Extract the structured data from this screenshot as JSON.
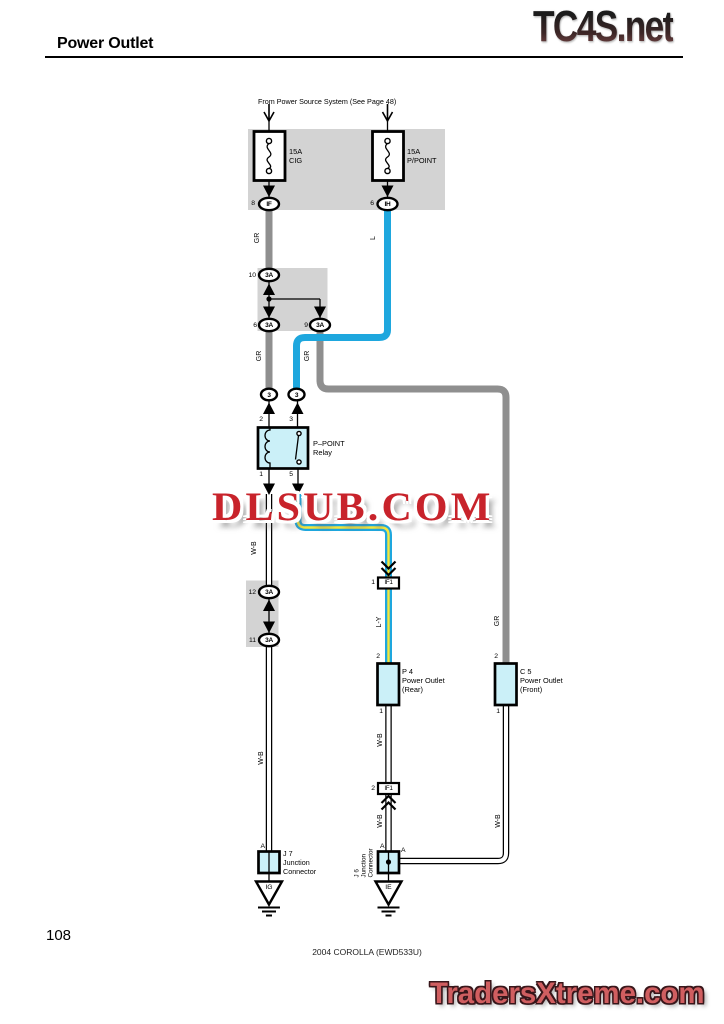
{
  "page": {
    "title": "Power Outlet",
    "page_number": "108",
    "footer_note": "2004 COROLLA (EWD533U)"
  },
  "watermarks": {
    "top_right": "TC4S.net",
    "center": "DLSUB.COM",
    "bottom_right": "TradersXtreme.com"
  },
  "colors": {
    "wire_blue": "#1ea7de",
    "wire_yellow": "#f5e73b",
    "wire_gray": "#8f8f8f",
    "box_gray": "#d3d3d3",
    "component_fill": "#cbf0f8",
    "watermark_red": "#c8232b"
  },
  "diagram": {
    "source_note": "From Power Source System (See Page 48)",
    "fuse_cig": {
      "amp": "15A",
      "name": "CIG",
      "pin": "8",
      "connector": "IF"
    },
    "fuse_ppoint": {
      "amp": "15A",
      "name": "P/POINT",
      "pin": "6",
      "connector": "IH"
    },
    "junction_a": {
      "top_pin": "10",
      "top": "3A",
      "left_pin": "6",
      "left": "3A",
      "right_pin": "9",
      "right": "3A"
    },
    "connector_left": "3",
    "connector_right": "3",
    "relay": {
      "pin_2": "2",
      "pin_3": "3",
      "pin_1": "1",
      "pin_5": "5",
      "name": "P–POINT",
      "type": "Relay"
    },
    "junction_b": {
      "top_pin": "12",
      "top": "3A",
      "bottom_pin": "11",
      "bottom": "3A"
    },
    "if1_upper": {
      "pin": "1",
      "name": "IF1"
    },
    "if1_lower": {
      "pin": "2",
      "name": "IF1"
    },
    "outlet_rear": {
      "pin_top": "2",
      "pin_bottom": "1",
      "code": "P 4",
      "name": "Power Outlet",
      "sub": "(Rear)"
    },
    "outlet_front": {
      "pin_top": "2",
      "pin_bottom": "1",
      "code": "C 5",
      "name": "Power Outlet",
      "sub": "(Front)"
    },
    "j7": {
      "pin": "A",
      "code": "J 7",
      "name": "Junction",
      "sub": "Connector",
      "ground": "IG"
    },
    "j6": {
      "pin": "A",
      "pin_right": "A",
      "code": "J 6",
      "name": "Junction",
      "sub": "Connector",
      "ground": "IE"
    },
    "wire_labels": {
      "gr": "GR",
      "l": "L",
      "wb": "W-B",
      "ly": "L-Y"
    }
  }
}
